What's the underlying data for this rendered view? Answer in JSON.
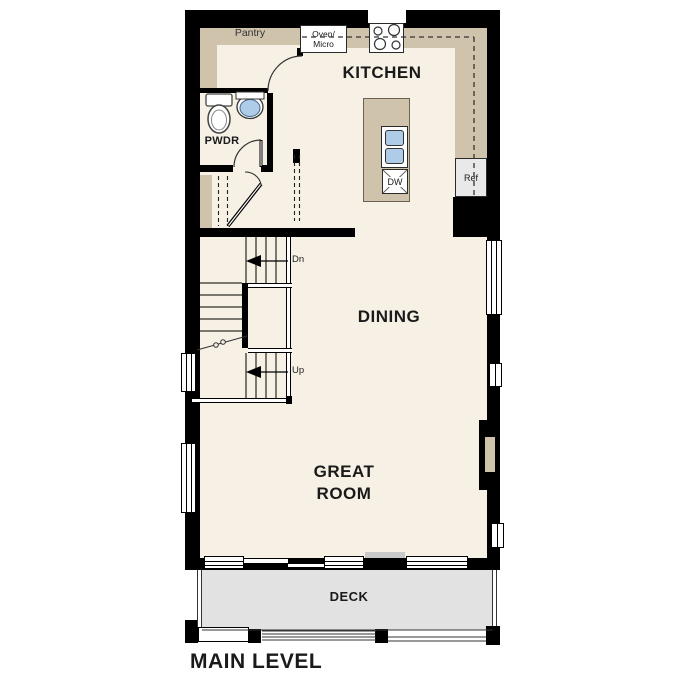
{
  "title": "MAIN LEVEL",
  "rooms": {
    "kitchen": "KITCHEN",
    "dining": "DINING",
    "great_room_line1": "GREAT",
    "great_room_line2": "ROOM",
    "deck": "DECK",
    "powder": "PWDR",
    "pantry": "Pantry"
  },
  "appliances": {
    "oven_micro_line1": "Oven/",
    "oven_micro_line2": "Micro",
    "ref": "Ref",
    "dw": "DW"
  },
  "stairs": {
    "down": "Dn",
    "up": "Up"
  },
  "fixtures": {
    "toilet": "toilet-icon",
    "powder_sink": "sink-icon",
    "island_sink": "double-basin-sink-icon",
    "cooktop": "cooktop-burners-icon",
    "fireplace": "fireplace-niche"
  },
  "colors": {
    "wall": "#000000",
    "floor": "#f6f0e5",
    "counter": "#cfc3ac",
    "deck": "#e2e2e2",
    "appliance": "#e9e9e9",
    "water": "#aecbe8"
  }
}
